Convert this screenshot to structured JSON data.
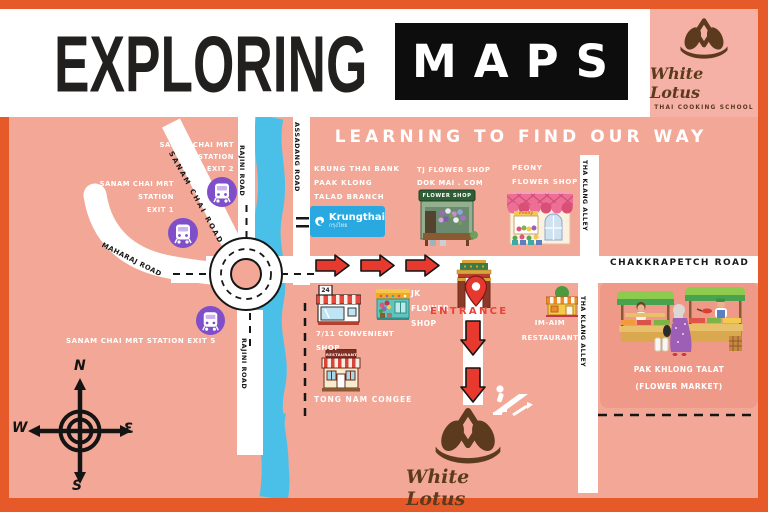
{
  "header": {
    "title_left": "EXPLORING",
    "title_boxed": "MAPS"
  },
  "brand": {
    "name": "White Lotus",
    "tagline": "THAI COOKING SCHOOL"
  },
  "subtitle": "LEARNING TO FIND OUR WAY",
  "roads": {
    "rajini": "RAJINI ROAD",
    "assadang": "ASSADANG ROAD",
    "sanam_chai": "SANAM CHAI ROAD",
    "maharaj": "MAHARAJ ROAD",
    "chakkrapetch": "CHAKKRAPETCH ROAD",
    "tha_klang": "THA KLANG ALLEY"
  },
  "stations": {
    "exit2": [
      "SANAM CHAI MRT",
      "STATION",
      "EXIT 2"
    ],
    "exit1": [
      "SANAM CHAI MRT",
      "STATION",
      "EXIT 1"
    ],
    "exit5": "SANAM CHAI MRT STATION EXIT 5"
  },
  "places": {
    "bank": {
      "lines": [
        "KRUNG THAI BANK",
        "PAAK KLONG",
        "TALAD BRANCH"
      ],
      "logo_text": "Krungthai",
      "logo_thai": "กรุงไทย"
    },
    "tj_flower": {
      "lines": [
        "TJ FLOWER SHOP",
        "DOK MAI . COM"
      ],
      "sign": "FLOWER SHOP"
    },
    "peony": {
      "lines": [
        "PEONY",
        "FLOWER SHOP"
      ],
      "sign": "Peony"
    },
    "seven_eleven": {
      "lines": [
        "7/11 CONVENIENT",
        "SHOP"
      ],
      "sign": "24"
    },
    "jk_flower": {
      "lines": [
        "JK",
        "FLOWER",
        "SHOP"
      ]
    },
    "congee": {
      "label": "TONG NAM CONGEE",
      "sign": "RESTAURANT"
    },
    "im_aim": {
      "lines": [
        "IM-AIM",
        "RESTAURANT"
      ]
    },
    "market": {
      "lines": [
        "PAK KHLONG TALAT",
        "(FLOWER MARKET)"
      ]
    },
    "entrance": "ENTRANCE"
  },
  "compass": {
    "n": "N",
    "e": "Ɛ",
    "s": "S",
    "w": "W"
  },
  "colors": {
    "frame": "#E65A2A",
    "map_bg": "#F3A796",
    "panel_bg": "#F5B1A5",
    "market_panel": "#EF9A89",
    "river": "#4AC0E8",
    "mrt_purple": "#7E4FC8",
    "arrow_red": "#E7392E",
    "entrance_red": "#E8433A",
    "brand_brown": "#5C3A1E",
    "krungthai_blue": "#2AA9E0"
  }
}
